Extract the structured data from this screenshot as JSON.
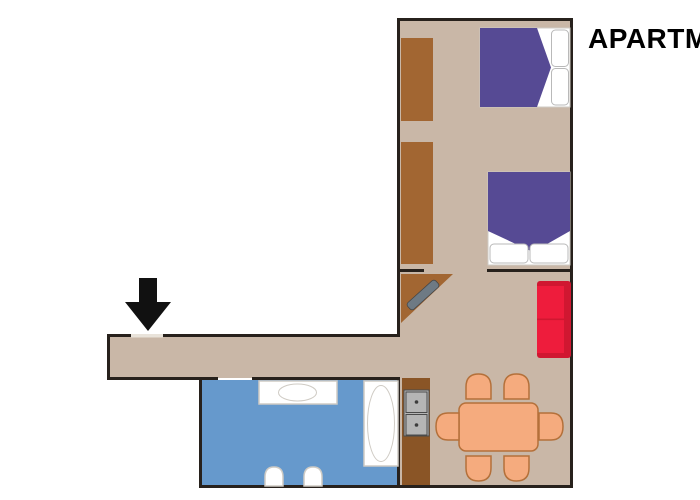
{
  "title": "APARTM",
  "colors": {
    "background": "#ffffff",
    "floor": "#c9b7a7",
    "wall": "#27211c",
    "wardrobe": "#a26632",
    "counter": "#8a5526",
    "bathroom_floor": "#6699cc",
    "fixture": "#ffffff",
    "fixture_outline": "#cfcbc4",
    "pillow_outline": "#b9b9b9",
    "bed_blanket": "#564a94",
    "sofa": "#ee1c3c",
    "sofa_edge": "#d01731",
    "dining": "#f5ab7e",
    "dining_outline": "#b4703a",
    "tv": "#6e7a84",
    "sink": "#b5b5b5",
    "arrow": "#111111",
    "threshold": "#e9e3da",
    "title_color": "#000000"
  },
  "plan": {
    "rooms": [
      "bedroom",
      "living-dining-room",
      "corridor",
      "bathroom"
    ],
    "furniture": [
      "wardrobe-upper",
      "wardrobe-lower",
      "double-bed-top",
      "double-bed-bottom",
      "corner-tv-stand",
      "tv",
      "sofa",
      "kitchen-counter",
      "kitchen-double-sink",
      "dining-table",
      "dining-chairs-x6",
      "bathroom-counter",
      "washbasin",
      "bathtub",
      "toilet-left",
      "toilet-right"
    ],
    "entrance": "down-arrow-at-entrance-door"
  }
}
